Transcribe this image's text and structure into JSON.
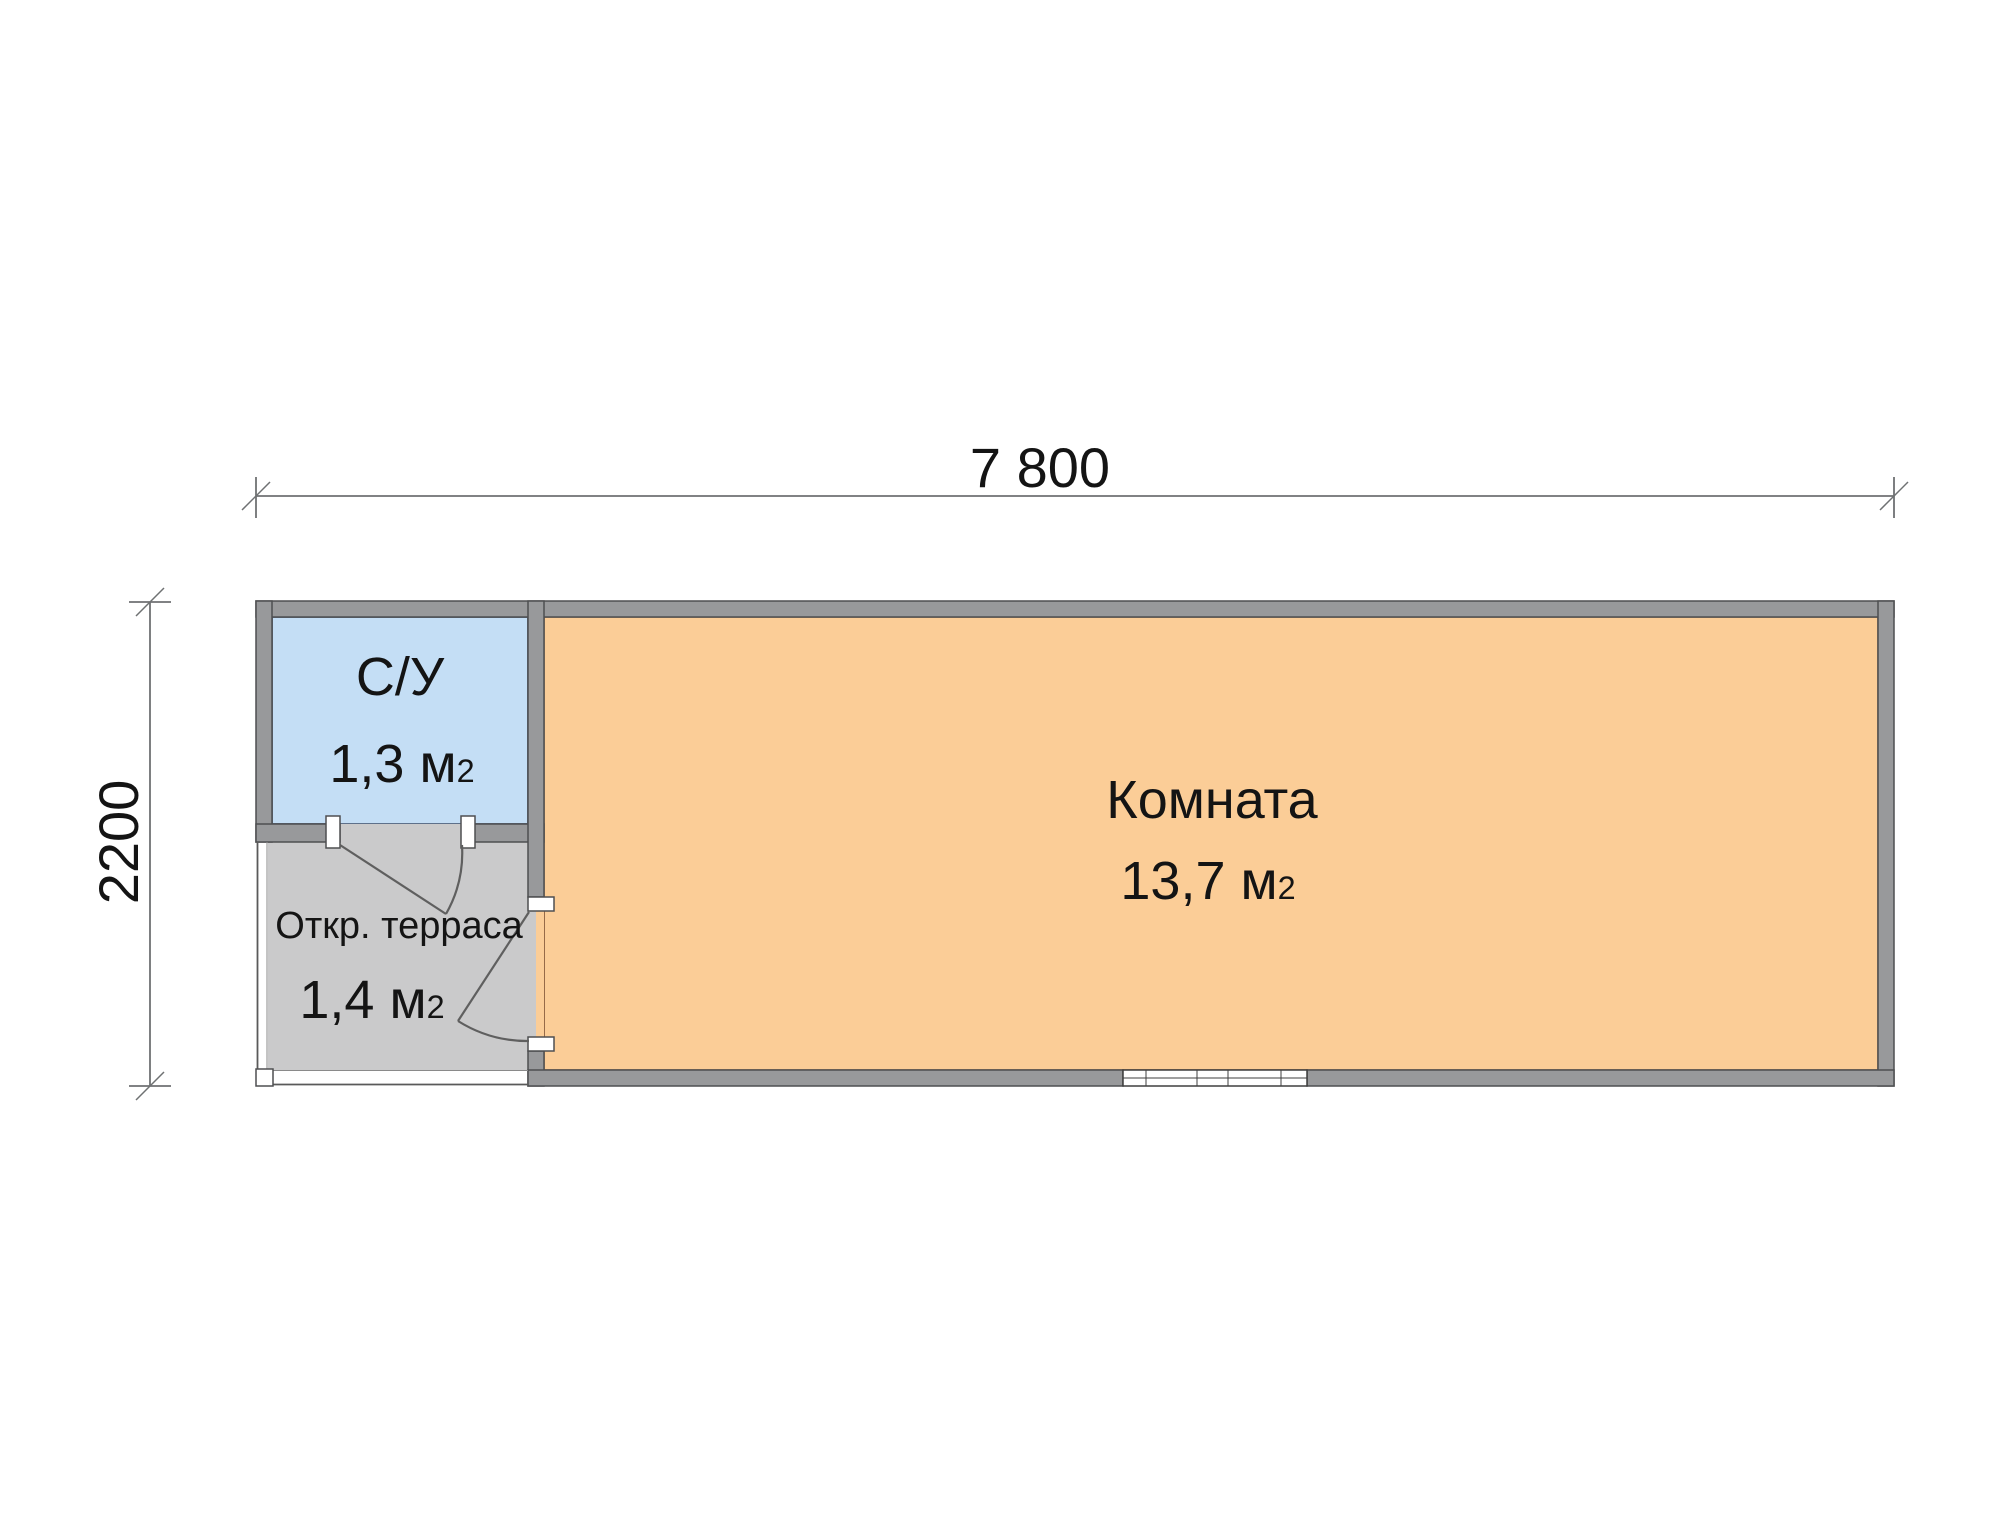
{
  "plan": {
    "dimensions": {
      "width": {
        "label": "7 800"
      },
      "height": {
        "label": "2200"
      }
    },
    "rooms": {
      "bathroom": {
        "name": "С/У",
        "area": "1,3 м",
        "area_sup": "2"
      },
      "terrace": {
        "name": "Откр. терраса",
        "area": "1,4 м",
        "area_sup": "2"
      },
      "room": {
        "name": "Комната",
        "area": "13,7 м",
        "area_sup": "2"
      }
    },
    "colors": {
      "wall": "#98999B",
      "bathroom_fill": "#C4DEF5",
      "terrace_fill": "#CACACB",
      "room_fill": "#FBCD97"
    }
  }
}
